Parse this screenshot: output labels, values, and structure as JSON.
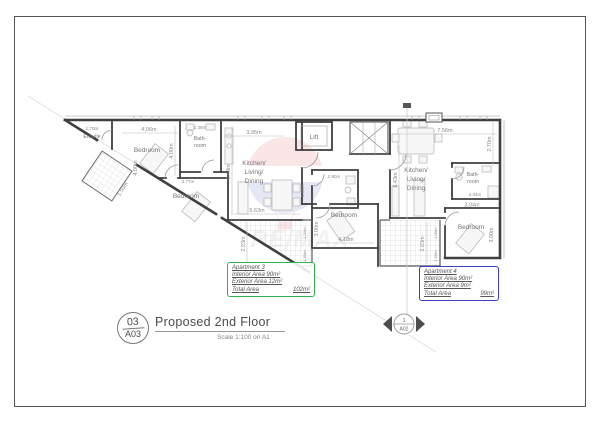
{
  "sheet": {
    "title_block": {
      "number": "03",
      "code": "A03",
      "title": "Proposed 2nd Floor",
      "scale_note": "Scale 1:100 on A1"
    },
    "section_marker": {
      "number": "1",
      "code": "A02"
    },
    "watermark_brand": "RE/MAX"
  },
  "apartments": {
    "apt3": {
      "name": "Apartment 3",
      "interior": "Interior Area 90m²",
      "exterior": "Exterior Area 12m²",
      "total_label": "Total Area",
      "total_value": "102m²",
      "accent": "#2fb14c"
    },
    "apt4": {
      "name": "Apartment 4",
      "interior": "Interior Area 90m²",
      "exterior": "Exterior Area 9m²",
      "total_label": "Total Area",
      "total_value": "99m²",
      "accent": "#3a3fc4"
    }
  },
  "rooms": {
    "ensuite": "Ensuite",
    "bedroom_nw": "Bedroom",
    "bath_nw_l1": "Bath-",
    "bath_nw_l2": "room",
    "bedroom_w": "Bedroom",
    "kitchen3_l1": "Kitchen/",
    "kitchen3_l2": "Living/",
    "kitchen3_l3": "Dining",
    "lift": "Lift",
    "bedroom_mid": "Bedroom",
    "kitchen4_l1": "Kitchen/",
    "kitchen4_l2": "Living/",
    "kitchen4_l3": "Dining",
    "bath_se_l1": "Bath-",
    "bath_se_l2": "room",
    "bedroom_se": "Bedroom"
  },
  "dims": {
    "ensuite_w": "1.70m",
    "bedroom_nw_w": "4.06m",
    "bath_nw_w": "2.36m",
    "kitchen3_top": "3.95m",
    "kitchen4_top": "7.56m",
    "kitchen4_right": "2.70m",
    "bedroom_nw_h": "4.00m",
    "bedroom_nw_h2": "4.00m",
    "kitchen3_h": "6.43m",
    "kitchen4_h": "6.43m",
    "kitchen3_bottom": "5.63m",
    "bedroom_w_w": "3.77m",
    "shaft_w": "1.50m",
    "terrace3_h": "2.93m",
    "terrace3_s1": "1.30m",
    "terrace3_s2": "1.50m",
    "bath_mid_w": "2.80m",
    "hall_h": "4.68m",
    "bedroom_mid_h": "3.00m",
    "bedroom_mid_w": "4.18m",
    "bath_se_w": "3.04m",
    "bedroom_se_w": "3.04m",
    "bedroom_se_h": "3.00m",
    "terrace4_h": "2.03m",
    "terrace4_s1": "1.30m",
    "terrace4_s2": "1.50m"
  },
  "colors": {
    "wall": "#3f3f3f",
    "thin_line": "#9a9a9a",
    "dim_text": "#8a8a8a",
    "room_text": "#757575",
    "apt3_accent": "#2fb14c",
    "apt4_accent": "#3a3fc4",
    "watermark_red": "#cc2229",
    "watermark_blue": "#16339c"
  }
}
